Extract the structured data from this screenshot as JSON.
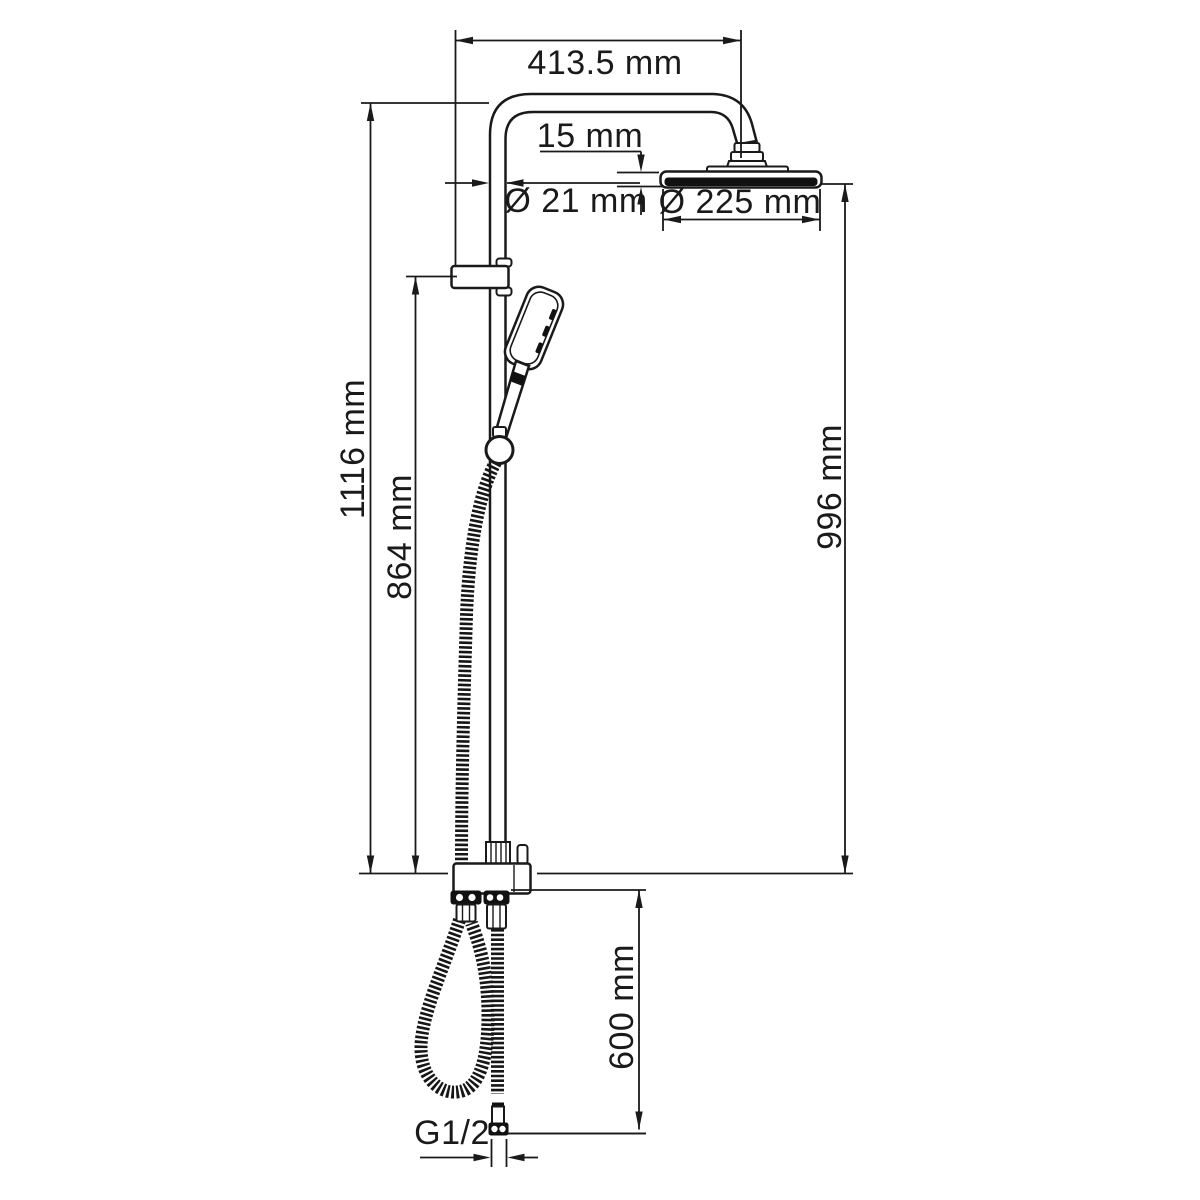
{
  "diagram": {
    "type": "technical-dimension-drawing",
    "subject": "shower-column-system",
    "labels": {
      "arm_length": "413.5 mm",
      "head_drop": "15 mm",
      "pipe_diameter": "Ø 21 mm",
      "head_diameter": "Ø 225 mm",
      "total_height": "1116 mm",
      "bracket_height": "864 mm",
      "head_height": "996 mm",
      "outlet_drop": "600 mm",
      "thread": "G1/2"
    },
    "colors": {
      "line": "#1a1a1a",
      "background": "#ffffff",
      "hose": "#161616"
    }
  }
}
